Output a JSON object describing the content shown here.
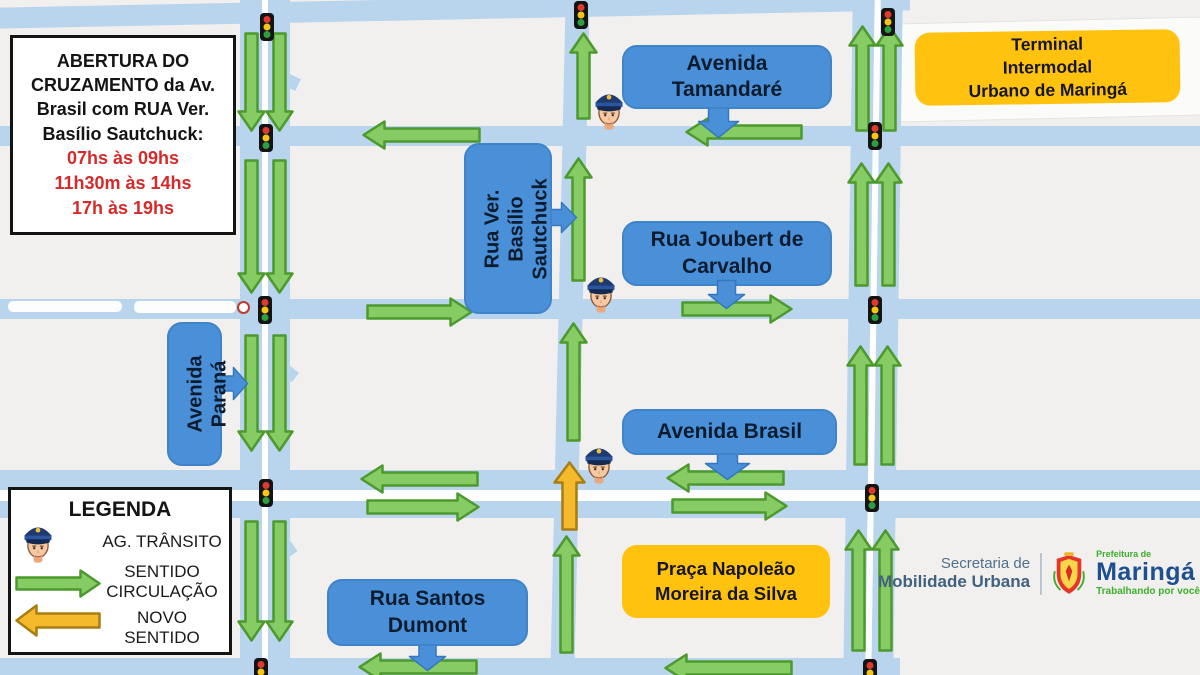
{
  "info_box": {
    "title": "ABERTURA DO\nCRUZAMENTO da Av.\nBrasil com RUA Ver.\nBasílio Sautchuck:",
    "times": "07hs às 09hs\n11h30m às 14hs\n17h às 19hs"
  },
  "street_labels": {
    "tamandare": "Avenida\nTamandaré",
    "basilio": "Rua Ver.\nBasílio\nSautchuck",
    "joubert": "Rua Joubert de\nCarvalho",
    "parana": "Avenida\nParaná",
    "brasil": "Avenida Brasil",
    "santos_dumont": "Rua Santos\nDumont"
  },
  "place_labels": {
    "terminal": "Terminal\nIntermodal\nUrbano de Maringá",
    "praca": "Praça Napoleão\nMoreira da Silva"
  },
  "legend": {
    "title": "LEGENDA",
    "agent": "AG. TRÂNSITO",
    "flow": "SENTIDO\nCIRCULAÇÃO",
    "new_direction": "NOVO\nSENTIDO"
  },
  "footer": {
    "secretaria_line1": "Secretaria de",
    "secretaria_line2": "Mobilidade Urbana",
    "prefeitura": "Prefeitura de",
    "city": "Maringá",
    "slogan": "Trabalhando por você"
  },
  "colors": {
    "road": "#b9d4ed",
    "label_blue": "#4a90d8",
    "label_yellow": "#ffc20e",
    "arrow_flow_green": "#86cb63",
    "arrow_new_yellow": "#f4ba2b",
    "times_red": "#d42a2a",
    "city_blue": "#1d4f91",
    "slogan_green": "#3dae2b"
  }
}
